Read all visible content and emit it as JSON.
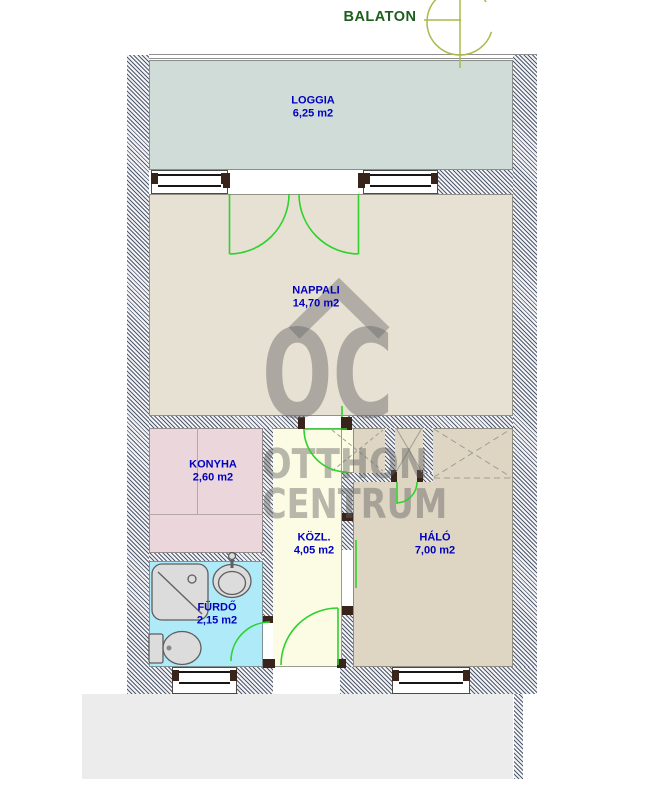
{
  "header": {
    "title": "BALATON"
  },
  "watermark": {
    "logo": "OC",
    "line1": "OTTHON",
    "line2": "CENTRUM"
  },
  "rooms": {
    "loggia": {
      "name": "LOGGIA",
      "area": "6,25 m2"
    },
    "nappali": {
      "name": "NAPPALI",
      "area": "14,70 m2"
    },
    "konyha": {
      "name": "KONYHA",
      "area": "2,60 m2"
    },
    "kozl": {
      "name": "KÖZL.",
      "area": "4,05 m2"
    },
    "halo": {
      "name": "HÁLÓ",
      "area": "7,00 m2"
    },
    "furdo": {
      "name": "FÜRDŐ",
      "area": "2,15 m2"
    }
  },
  "colors": {
    "label_blue": "#0000bf",
    "title_green": "#1d5e1d",
    "door_green": "#2ed12e",
    "compass_olive": "#a9ba4a",
    "wall_hatch": "#515b6e",
    "loggia_fill": "#cfdcd7",
    "nappali_fill": "#e7e1d3",
    "konyha_fill": "#ebd6db",
    "kozl_fill": "#fbfce3",
    "halo_fill": "#ded6c3",
    "furdo_fill": "#aeeaf8",
    "terrace_fill": "#ececec",
    "watermark_gray": "#999999"
  }
}
